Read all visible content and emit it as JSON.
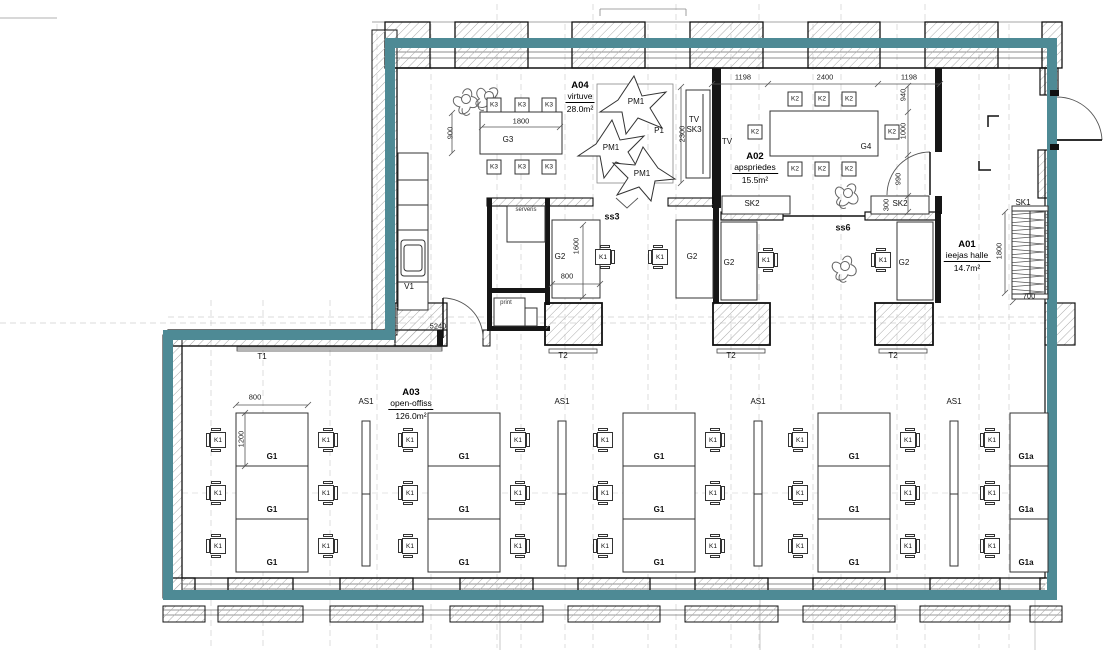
{
  "drawing": {
    "type": "architectural-floor-plan",
    "accent_color": "#4e8a95",
    "rooms": [
      {
        "code": "A04",
        "name": "virtuve",
        "area": "28.0m²",
        "x": 580,
        "y": 97
      },
      {
        "code": "A02",
        "name": "apspriedes",
        "area": "15.5m²",
        "x": 755,
        "y": 168
      },
      {
        "code": "A01",
        "name": "ieejas halle",
        "area": "14.7m²",
        "x": 967,
        "y": 256
      },
      {
        "code": "A03",
        "name": "open-offiss",
        "area": "126.0m²",
        "x": 411,
        "y": 404
      }
    ],
    "labels": [
      {
        "t": "ss3",
        "x": 612,
        "y": 217,
        "c": "b"
      },
      {
        "t": "ss6",
        "x": 843,
        "y": 228,
        "c": "b"
      },
      {
        "t": "serveris",
        "x": 526,
        "y": 210,
        "c": "y"
      },
      {
        "t": "print",
        "x": 506,
        "y": 303,
        "c": "y"
      },
      {
        "t": "V1",
        "x": 409,
        "y": 287
      },
      {
        "t": "T1",
        "x": 262,
        "y": 357
      },
      {
        "t": "T2",
        "x": 563,
        "y": 356
      },
      {
        "t": "T2",
        "x": 731,
        "y": 356
      },
      {
        "t": "T2",
        "x": 893,
        "y": 356
      },
      {
        "t": "SK1",
        "x": 1023,
        "y": 203
      },
      {
        "t": "SK2",
        "x": 752,
        "y": 204
      },
      {
        "t": "SK2",
        "x": 900,
        "y": 204
      },
      {
        "t": "TV",
        "x": 694,
        "y": 120
      },
      {
        "t": "SK3",
        "x": 694,
        "y": 130
      },
      {
        "t": "TV",
        "x": 727,
        "y": 142
      },
      {
        "t": "G3",
        "x": 508,
        "y": 140
      },
      {
        "t": "G4",
        "x": 866,
        "y": 147
      },
      {
        "t": "G2",
        "x": 560,
        "y": 257
      },
      {
        "t": "G2",
        "x": 692,
        "y": 257
      },
      {
        "t": "G2",
        "x": 729,
        "y": 263
      },
      {
        "t": "G2",
        "x": 904,
        "y": 263
      },
      {
        "t": "AS1",
        "x": 366,
        "y": 402
      },
      {
        "t": "AS1",
        "x": 562,
        "y": 402
      },
      {
        "t": "AS1",
        "x": 758,
        "y": 402
      },
      {
        "t": "AS1",
        "x": 954,
        "y": 402
      },
      {
        "t": "PM1",
        "x": 636,
        "y": 102
      },
      {
        "t": "PM1",
        "x": 611,
        "y": 148
      },
      {
        "t": "PM1",
        "x": 642,
        "y": 174
      },
      {
        "t": "P1",
        "x": 659,
        "y": 131
      },
      {
        "t": "G1",
        "x": 272,
        "y": 457,
        "c": "g"
      },
      {
        "t": "G1",
        "x": 272,
        "y": 510,
        "c": "g"
      },
      {
        "t": "G1",
        "x": 272,
        "y": 563,
        "c": "g"
      },
      {
        "t": "G1",
        "x": 464,
        "y": 457,
        "c": "g"
      },
      {
        "t": "G1",
        "x": 464,
        "y": 510,
        "c": "g"
      },
      {
        "t": "G1",
        "x": 464,
        "y": 563,
        "c": "g"
      },
      {
        "t": "G1",
        "x": 659,
        "y": 457,
        "c": "g"
      },
      {
        "t": "G1",
        "x": 659,
        "y": 510,
        "c": "g"
      },
      {
        "t": "G1",
        "x": 659,
        "y": 563,
        "c": "g"
      },
      {
        "t": "G1",
        "x": 854,
        "y": 457,
        "c": "g"
      },
      {
        "t": "G1",
        "x": 854,
        "y": 510,
        "c": "g"
      },
      {
        "t": "G1",
        "x": 854,
        "y": 563,
        "c": "g"
      },
      {
        "t": "G1a",
        "x": 1026,
        "y": 457,
        "c": "g"
      },
      {
        "t": "G1a",
        "x": 1026,
        "y": 510,
        "c": "g"
      },
      {
        "t": "G1a",
        "x": 1026,
        "y": 563,
        "c": "g"
      }
    ],
    "dimensions": [
      {
        "t": "1800",
        "x": 521,
        "y": 121
      },
      {
        "t": "900",
        "x": 450,
        "y": 133,
        "r": 1
      },
      {
        "t": "2300",
        "x": 682,
        "y": 134,
        "r": 1
      },
      {
        "t": "1198",
        "x": 743,
        "y": 77
      },
      {
        "t": "2400",
        "x": 825,
        "y": 77
      },
      {
        "t": "1198",
        "x": 909,
        "y": 77
      },
      {
        "t": "940",
        "x": 903,
        "y": 95,
        "r": 1
      },
      {
        "t": "1000",
        "x": 903,
        "y": 131,
        "r": 1
      },
      {
        "t": "990",
        "x": 898,
        "y": 179,
        "r": 1
      },
      {
        "t": "300",
        "x": 886,
        "y": 205,
        "r": 1
      },
      {
        "t": "1600",
        "x": 576,
        "y": 246,
        "r": 1
      },
      {
        "t": "800",
        "x": 567,
        "y": 276
      },
      {
        "t": "5240",
        "x": 438,
        "y": 326
      },
      {
        "t": "800",
        "x": 255,
        "y": 397
      },
      {
        "t": "1200",
        "x": 241,
        "y": 439,
        "r": 1
      },
      {
        "t": "1800",
        "x": 999,
        "y": 251,
        "r": 1
      },
      {
        "t": "700",
        "x": 1029,
        "y": 296
      }
    ],
    "chairs": [
      {
        "t": "K3",
        "x": 494,
        "y": 105,
        "f": "d",
        "s": 1
      },
      {
        "t": "K3",
        "x": 522,
        "y": 105,
        "f": "d",
        "s": 1
      },
      {
        "t": "K3",
        "x": 549,
        "y": 105,
        "f": "d",
        "s": 1
      },
      {
        "t": "K3",
        "x": 494,
        "y": 167,
        "f": "u",
        "s": 1
      },
      {
        "t": "K3",
        "x": 522,
        "y": 167,
        "f": "u",
        "s": 1
      },
      {
        "t": "K3",
        "x": 549,
        "y": 167,
        "f": "u",
        "s": 1
      },
      {
        "t": "K2",
        "x": 795,
        "y": 99,
        "f": "d",
        "s": 1
      },
      {
        "t": "K2",
        "x": 822,
        "y": 99,
        "f": "d",
        "s": 1
      },
      {
        "t": "K2",
        "x": 849,
        "y": 99,
        "f": "d",
        "s": 1
      },
      {
        "t": "K2",
        "x": 795,
        "y": 169,
        "f": "u",
        "s": 1
      },
      {
        "t": "K2",
        "x": 822,
        "y": 169,
        "f": "u",
        "s": 1
      },
      {
        "t": "K2",
        "x": 849,
        "y": 169,
        "f": "u",
        "s": 1
      },
      {
        "t": "K2",
        "x": 755,
        "y": 132,
        "f": "r",
        "s": 1
      },
      {
        "t": "K2",
        "x": 892,
        "y": 132,
        "f": "l",
        "s": 1
      },
      {
        "t": "K1",
        "x": 603,
        "y": 257,
        "f": "l"
      },
      {
        "t": "K1",
        "x": 660,
        "y": 257,
        "f": "r"
      },
      {
        "t": "K1",
        "x": 766,
        "y": 260,
        "f": "l"
      },
      {
        "t": "K1",
        "x": 883,
        "y": 260,
        "f": "r"
      },
      {
        "t": "K1",
        "x": 218,
        "y": 440,
        "f": "r"
      },
      {
        "t": "K1",
        "x": 218,
        "y": 493,
        "f": "r"
      },
      {
        "t": "K1",
        "x": 218,
        "y": 546,
        "f": "r"
      },
      {
        "t": "K1",
        "x": 326,
        "y": 440,
        "f": "l"
      },
      {
        "t": "K1",
        "x": 326,
        "y": 493,
        "f": "l"
      },
      {
        "t": "K1",
        "x": 326,
        "y": 546,
        "f": "l"
      },
      {
        "t": "K1",
        "x": 410,
        "y": 440,
        "f": "r"
      },
      {
        "t": "K1",
        "x": 410,
        "y": 493,
        "f": "r"
      },
      {
        "t": "K1",
        "x": 410,
        "y": 546,
        "f": "r"
      },
      {
        "t": "K1",
        "x": 518,
        "y": 440,
        "f": "l"
      },
      {
        "t": "K1",
        "x": 518,
        "y": 493,
        "f": "l"
      },
      {
        "t": "K1",
        "x": 518,
        "y": 546,
        "f": "l"
      },
      {
        "t": "K1",
        "x": 605,
        "y": 440,
        "f": "r"
      },
      {
        "t": "K1",
        "x": 605,
        "y": 493,
        "f": "r"
      },
      {
        "t": "K1",
        "x": 605,
        "y": 546,
        "f": "r"
      },
      {
        "t": "K1",
        "x": 713,
        "y": 440,
        "f": "l"
      },
      {
        "t": "K1",
        "x": 713,
        "y": 493,
        "f": "l"
      },
      {
        "t": "K1",
        "x": 713,
        "y": 546,
        "f": "l"
      },
      {
        "t": "K1",
        "x": 800,
        "y": 440,
        "f": "r"
      },
      {
        "t": "K1",
        "x": 800,
        "y": 493,
        "f": "r"
      },
      {
        "t": "K1",
        "x": 800,
        "y": 546,
        "f": "r"
      },
      {
        "t": "K1",
        "x": 908,
        "y": 440,
        "f": "l"
      },
      {
        "t": "K1",
        "x": 908,
        "y": 493,
        "f": "l"
      },
      {
        "t": "K1",
        "x": 908,
        "y": 546,
        "f": "l"
      },
      {
        "t": "K1",
        "x": 992,
        "y": 440,
        "f": "r"
      },
      {
        "t": "K1",
        "x": 992,
        "y": 493,
        "f": "r"
      },
      {
        "t": "K1",
        "x": 992,
        "y": 546,
        "f": "r"
      }
    ]
  }
}
